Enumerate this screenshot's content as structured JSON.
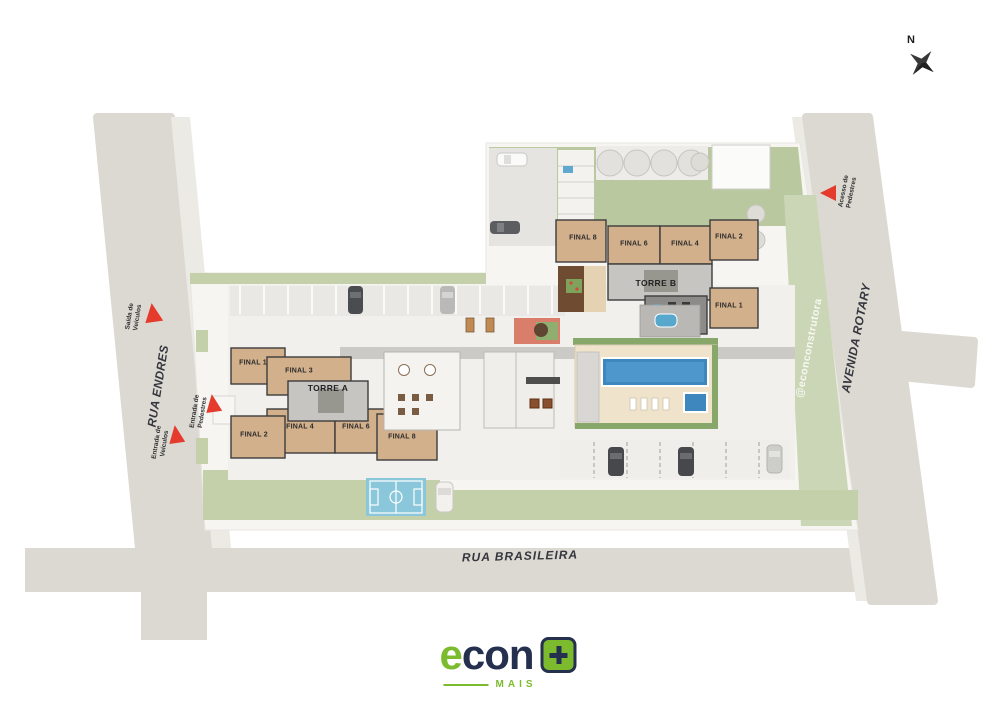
{
  "compass": {
    "label": "N"
  },
  "streets": {
    "rua_endres": "RUA ENDRES",
    "rua_brasileira": "RUA BRASILEIRA",
    "avenida_rotary": "AVENIDA ROTARY"
  },
  "access": {
    "saida_veiculos": "Saída de Veículos",
    "entrada_pedestres": "Entrada de Pedestres",
    "entrada_veiculos": "Entrada de Veículos",
    "acesso_pedestres": "Acesso de Pedestres"
  },
  "towers": {
    "torre_a": {
      "name": "TORRE A",
      "units": {
        "final1": "FINAL 1",
        "final2": "FINAL 2",
        "final3": "FINAL 3",
        "final4": "FINAL 4",
        "final6": "FINAL 6",
        "final8": "FINAL 8"
      }
    },
    "torre_b": {
      "name": "TORRE B",
      "units": {
        "final1": "FINAL 1",
        "final2": "FINAL 2",
        "final4": "FINAL 4",
        "final6": "FINAL 6",
        "final8": "FINAL 8"
      }
    }
  },
  "watermark": "@econconstrutora",
  "logo": {
    "e": "e",
    "con": "con",
    "mais": "MAIS"
  },
  "colors": {
    "street": "#dcd9d2",
    "sidewalk": "#eceae5",
    "site": "#f6f5f2",
    "lawn": "#bfcda4",
    "hedge": "#9db97e",
    "building_tan": "#d3b08c",
    "outline": "#3c3c3c",
    "pool_blue": "#3d86be",
    "field_blue": "#8bc7da",
    "accent_red": "#e43b2c",
    "logo_green": "#7cbb2e",
    "logo_navy": "#25304f"
  }
}
